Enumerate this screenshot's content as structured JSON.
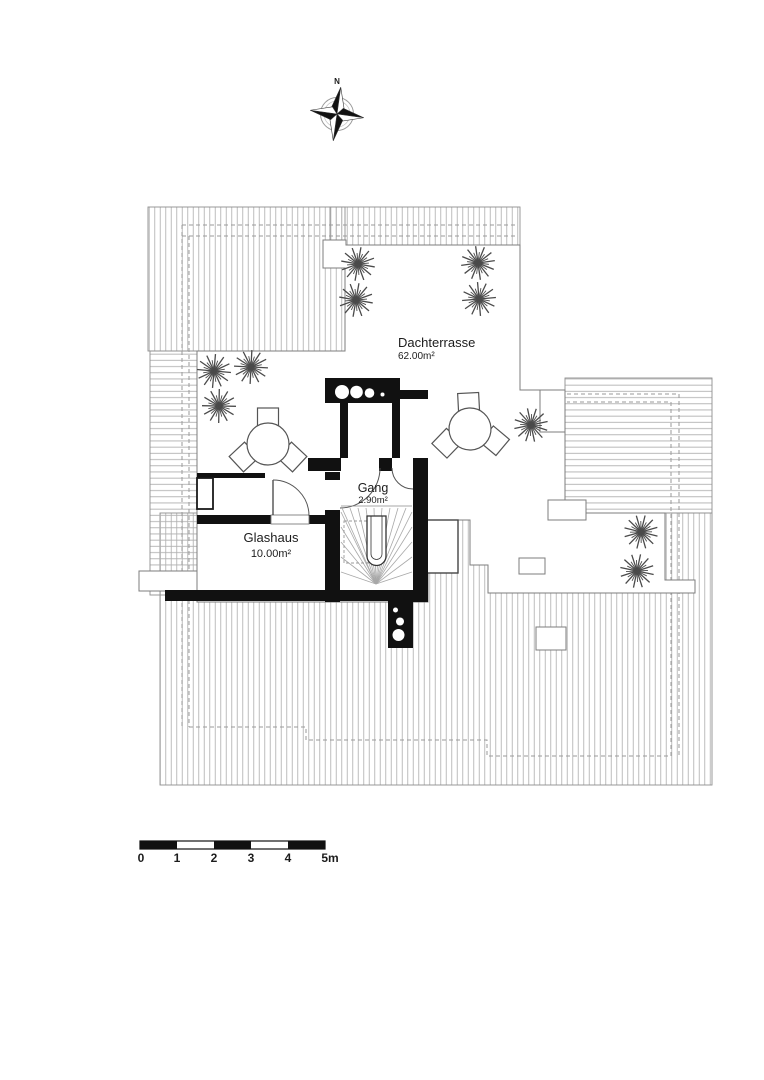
{
  "compass": {
    "north_label": "N"
  },
  "rooms": {
    "dachterrasse": {
      "name": "Dachterrasse",
      "area": "62.00m²"
    },
    "gang": {
      "name": "Gang",
      "area": "2.90m²"
    },
    "glashaus": {
      "name": "Glashaus",
      "area": "10.00m²"
    }
  },
  "scale_bar": {
    "unit": "m",
    "ticks": [
      "0",
      "1",
      "2",
      "3",
      "4",
      "5m"
    ]
  },
  "colors": {
    "background": "#ffffff",
    "wall": "#111111",
    "hatch_line": "#b5b5b5",
    "outline": "#8c8c8c",
    "dashed_line": "#9a9a9a",
    "text": "#1c1c1c"
  }
}
